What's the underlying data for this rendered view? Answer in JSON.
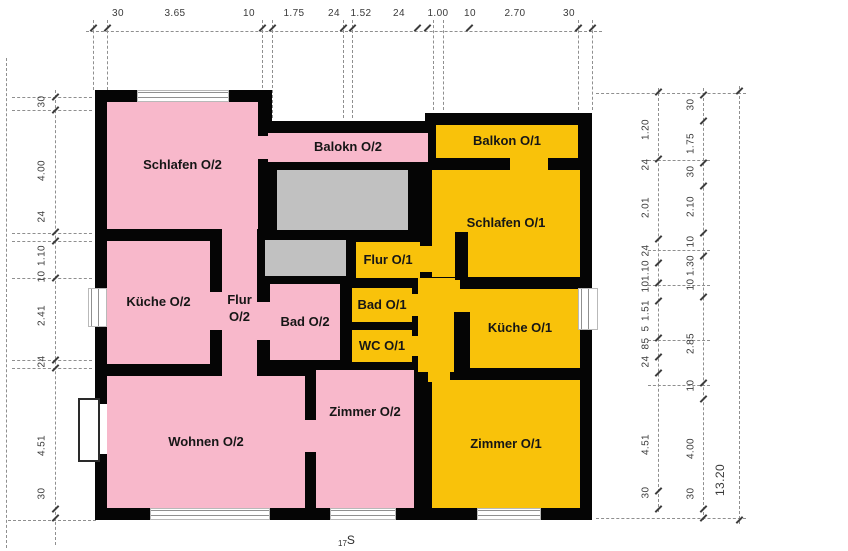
{
  "plan": {
    "type": "apartment floor plan (scanned architectural drawing, upper floor)",
    "colors": {
      "o2": "#F8B8CB",
      "o1": "#F9C20A",
      "stair": "#C1C1C1",
      "wall": "#050505",
      "dimline": "#8f8f8f",
      "dimtext": "#3a3a3a"
    },
    "apartments": [
      {
        "name": "O/2",
        "color": "#F8B8CB"
      },
      {
        "name": "O/1",
        "color": "#F9C20A"
      }
    ],
    "rooms": [
      {
        "id": "schlafen-o2",
        "label": "Schlafen O/2",
        "apartment": "O/2"
      },
      {
        "id": "balkon-o2",
        "label": "Balokn O/2",
        "apartment": "O/2"
      },
      {
        "id": "balkon-o1",
        "label": "Balkon O/1",
        "apartment": "O/1"
      },
      {
        "id": "schlafen-o1",
        "label": "Schlafen O/1",
        "apartment": "O/1"
      },
      {
        "id": "flur-o2",
        "label": "Flur O/2",
        "apartment": "O/2"
      },
      {
        "id": "kueche-o2",
        "label": "Küche O/2",
        "apartment": "O/2"
      },
      {
        "id": "bad-o2",
        "label": "Bad O/2",
        "apartment": "O/2"
      },
      {
        "id": "flur-o1",
        "label": "Flur O/1",
        "apartment": "O/1"
      },
      {
        "id": "bad-o1",
        "label": "Bad O/1",
        "apartment": "O/1"
      },
      {
        "id": "wc-o1",
        "label": "WC O/1",
        "apartment": "O/1"
      },
      {
        "id": "kueche-o1",
        "label": "Küche O/1",
        "apartment": "O/1"
      },
      {
        "id": "wohnen-o2",
        "label": "Wohnen O/2",
        "apartment": "O/2"
      },
      {
        "id": "zimmer-o2",
        "label": "Zimmer O/2",
        "apartment": "O/2"
      },
      {
        "id": "zimmer-o1",
        "label": "Zimmer O/1",
        "apartment": "O/1"
      }
    ],
    "mark": {
      "prefix": "17",
      "letter": "S"
    }
  },
  "dimensions": {
    "top": [
      "30",
      "3.65",
      "10",
      "1.75",
      "24",
      "1.52",
      "24",
      "1.00",
      "10",
      "2.70",
      "30"
    ],
    "left": [
      "30",
      "4.00",
      "24",
      "1.10",
      "10",
      "2.41",
      "24",
      "4.51",
      "30"
    ],
    "right_inner": [
      "1.20",
      "24",
      "2.01",
      "24",
      "1.10",
      "10",
      "1.51",
      "5",
      "85",
      "24",
      "4.51",
      "30"
    ],
    "right_outer": [
      "30",
      "1.75",
      "30",
      "2.10",
      "10",
      "1.30",
      "10",
      "2.85",
      "10",
      "4.00",
      "30"
    ],
    "right_total": "13.20"
  }
}
